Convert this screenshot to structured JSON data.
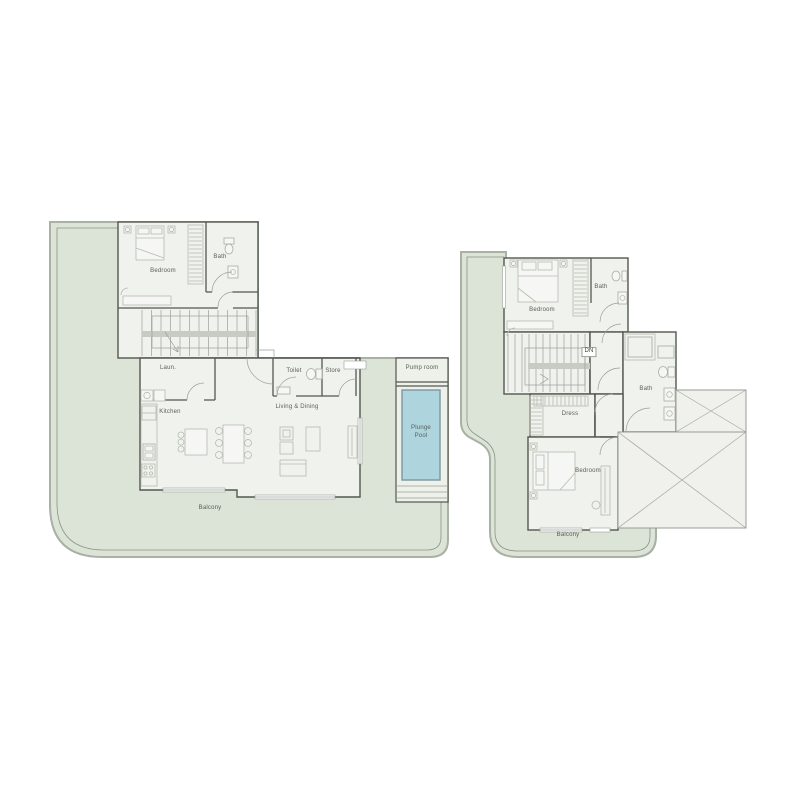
{
  "colors": {
    "background": "#ffffff",
    "balcony": "#dce3d7",
    "balcony_edge": "#a9b0a4",
    "railing": "#8b9287",
    "floor": "#f0f2ee",
    "wall": "#54574f",
    "pool": "#aed5de",
    "pool_edge": "#7b98a1",
    "stair_strip": "#c7cbc1",
    "label_text": "#5a5e57"
  },
  "left_plan": {
    "rooms": {
      "bedroom": "Bedroom",
      "bath": "Bath",
      "laundry": "Laun.",
      "toilet": "Toilet",
      "store": "Store",
      "kitchen": "Kitchen",
      "living_dining": "Living & Dining",
      "pump_room": "Pump room",
      "plunge_pool": "Plunge\nPool",
      "balcony": "Balcony"
    }
  },
  "right_plan": {
    "rooms": {
      "bedroom_upper": "Bedroom",
      "bath_upper": "Bath",
      "stairs_direction": "DN",
      "dress": "Dress",
      "bath": "Bath",
      "bedroom_lower": "Bedroom",
      "balcony": "Balcony"
    }
  }
}
